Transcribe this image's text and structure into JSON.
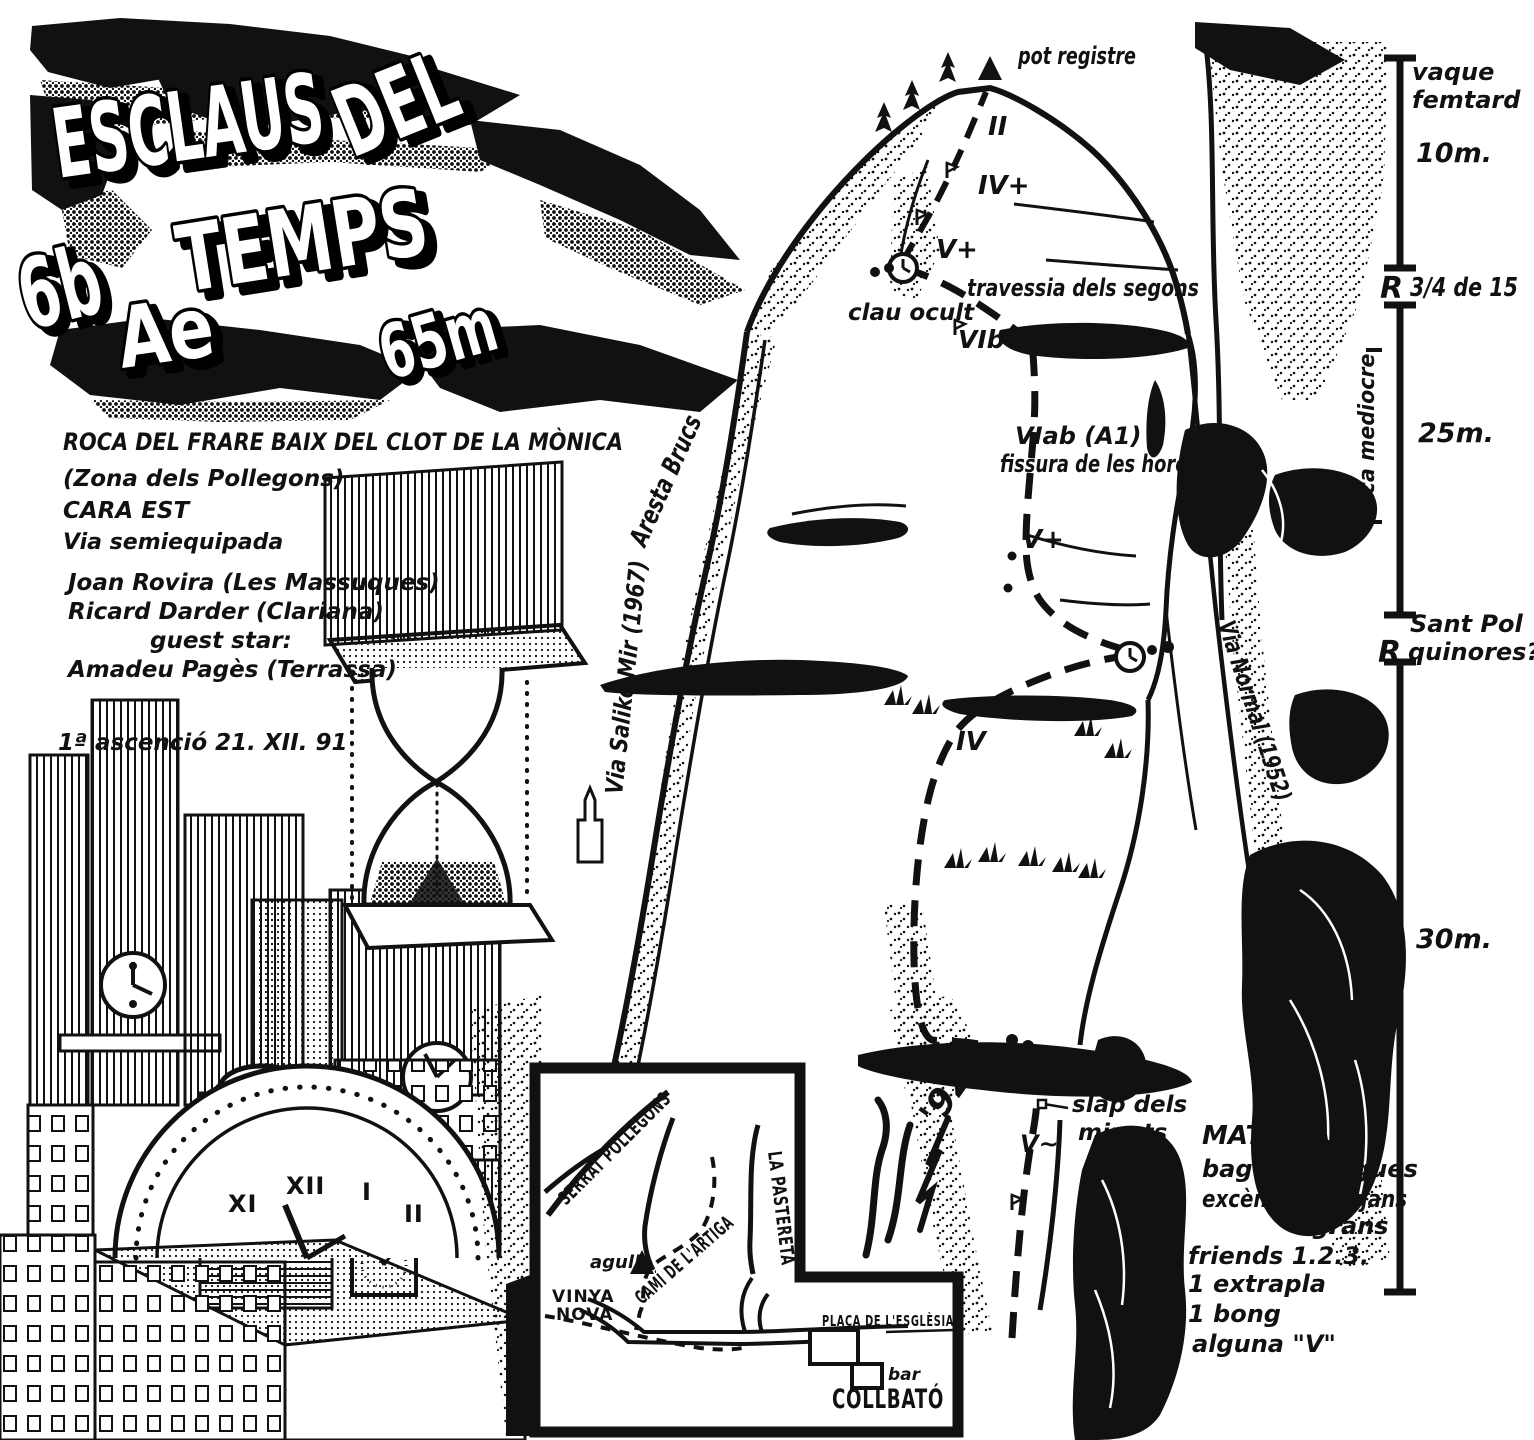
{
  "colors": {
    "ink": "#111111",
    "paper": "#ffffff"
  },
  "title": {
    "word1": "ESCLAUS",
    "word2": "DEL",
    "word3": "TEMPS",
    "grade": "6b",
    "aid_grade": "Ae",
    "length": "65m"
  },
  "route_info": {
    "crag": "ROCA DEL FRARE BAIX DEL CLOT DE LA MÒNICA",
    "zone": "(Zona dels Pollegons)",
    "face": "CARA EST",
    "equipment": "Via semiequipada",
    "author1": "Joan Rovira (Les Massuques)",
    "author2": "Ricard Darder (Clariana)",
    "guest_label": "guest star:",
    "guest": "Amadeu Pagès (Terrassa)",
    "first_ascent": "1ª ascenció  21. XII. 91"
  },
  "topo_labels": {
    "pot_registre": "pot registre",
    "pitch_II": "II",
    "pitch_IVplus": "IV+",
    "pitch_Vplus_upper": "V+",
    "travessia": "travessia dels segons",
    "clau_ocult": "clau ocult",
    "pitch_VIb": "VIb",
    "pitch_VIab": "VIab (A1)",
    "fissura": "fissura de les hores",
    "pitch_Vplus_mid": "V+",
    "pitch_IV": "IV",
    "pitch_Ae": "Ae",
    "slap_line1": "slap dels",
    "slap_line2": "minuts",
    "pitch_V_slab": "V~",
    "via_salike": "Via Salike Mir (1967)",
    "aresta_brucs": "Aresta Brucs",
    "via_normal": "Via Normal (1952)"
  },
  "scale": {
    "belay1_line1": "vaque",
    "belay1_line2": "femtard",
    "pitch1_length": "10m.",
    "r_mid": "R",
    "r_mid_text": "3/4 de 15",
    "rock_quality": "roca mediocre",
    "pitch2_length": "25m.",
    "belay3_line1": "Sant Pol",
    "belay3_line2": "quinores?",
    "r_low": "R",
    "pitch3_length": "30m."
  },
  "material": {
    "header": "MATERIAL:",
    "items": [
      "bagues llargues",
      "excèntrics mitjans",
      "grans",
      "friends 1.2.3.",
      "1 extrapla",
      "1 bong",
      "alguna \"V\""
    ]
  },
  "map": {
    "serrat": "SERRAT POLLEGONS",
    "pastereta": "LA PASTERETA",
    "agulla": "agulla",
    "cami": "CAMÍ DE L'ARTIGA",
    "vinya_line1": "VINYA",
    "vinya_line2": "NOVA",
    "placa": "PLAÇA DE L'ESGLÈSIA",
    "bar": "bar",
    "town": "COLLBATÓ"
  },
  "clock_numerals": {
    "n1": "XI",
    "n2": "XII",
    "n3": "I",
    "n4": "II"
  },
  "signature": {
    "year": "'92"
  }
}
